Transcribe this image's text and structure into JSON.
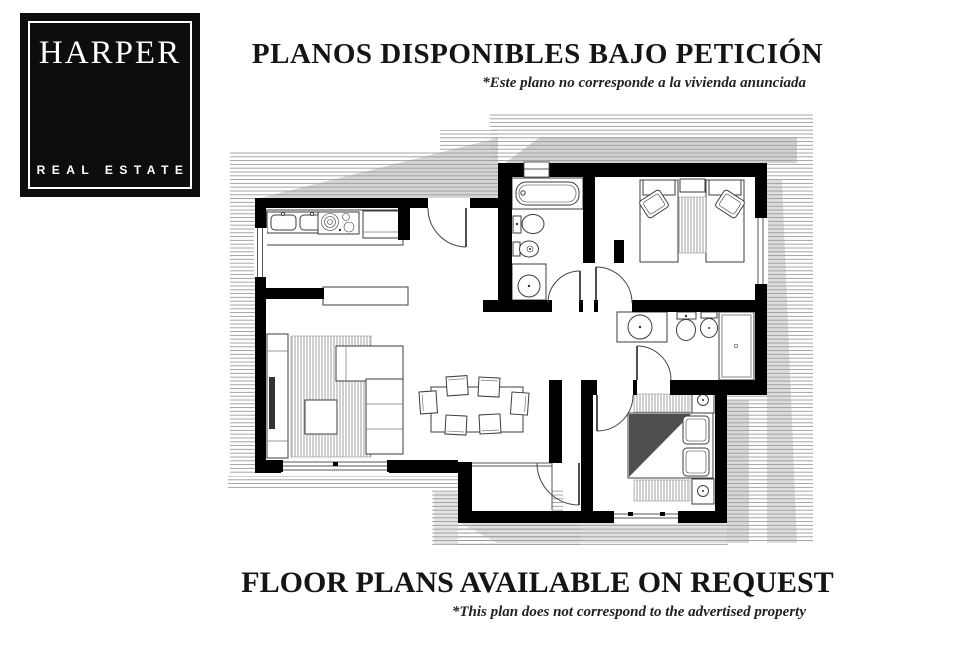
{
  "logo": {
    "brand": "HARPER",
    "tagline": "REAL ESTATE",
    "colors": {
      "background": "#0d0d0d",
      "text": "#ffffff"
    }
  },
  "header": {
    "title": "PLANOS DISPONIBLES BAJO PETICIÓN",
    "disclaimer": "*Este plano no corresponde a la vivienda anunciada"
  },
  "footer": {
    "title": "FLOOR PLANS AVAILABLE ON REQUEST",
    "disclaimer": "*This plan does not correspond to the advertised property"
  },
  "floorplan": {
    "colors": {
      "wall": "#000000",
      "hatch": "#9b9b9b",
      "shadow": "#b3b3b3",
      "fixture": "#3d3d3d",
      "blanket": "#4f4f4f",
      "rug_stripe": "#8a8a8a"
    }
  }
}
